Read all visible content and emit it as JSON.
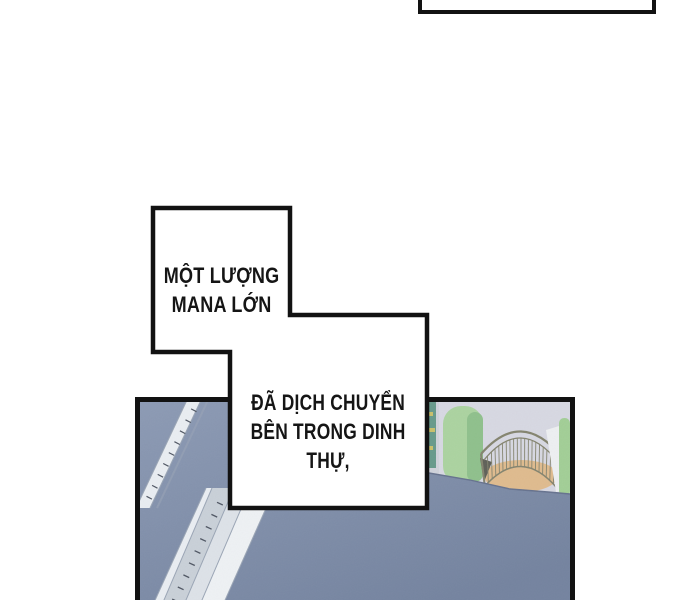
{
  "page_type": "webtoon-comic-page",
  "speech": {
    "box1": {
      "line1": "MỘT LƯỢNG",
      "line2": "MANA LỚN"
    },
    "box2": {
      "line1": "ĐÃ DỊCH CHUYỂN",
      "line2": "BÊN TRONG DINH",
      "line3": "THỰ,"
    }
  },
  "panel": {
    "scene": "aerial-view-of-mansion-rooftop",
    "elements": [
      "slate-blue-roof",
      "diagonal-walkway-railing",
      "diagonal-walkway-lattice",
      "curved-terrace-railing",
      "terrace-floor",
      "garden-hedges"
    ]
  },
  "colors": {
    "page_bg": "#ffffff",
    "bubble_fill": "#ffffff",
    "bubble_border": "#121212",
    "text_color": "#151515",
    "panel_border": "#121212",
    "roof": "#74839f",
    "roof_light": "#8c9ab4",
    "roof_edge": "#66728e",
    "walkway": "#e9edf2",
    "walkway_edge": "#9aa5b5",
    "walkway_tick": "#4f5663",
    "lattice": "#c9d0d8",
    "terrace_bg": "#d7d8e2",
    "terrace_floor": "#dfbb8e",
    "hedge_green": "#abd3a0",
    "hedge_green_shade": "#8fc08c",
    "teal_hedge": "#679a8b",
    "railing_line": "#84846f"
  }
}
